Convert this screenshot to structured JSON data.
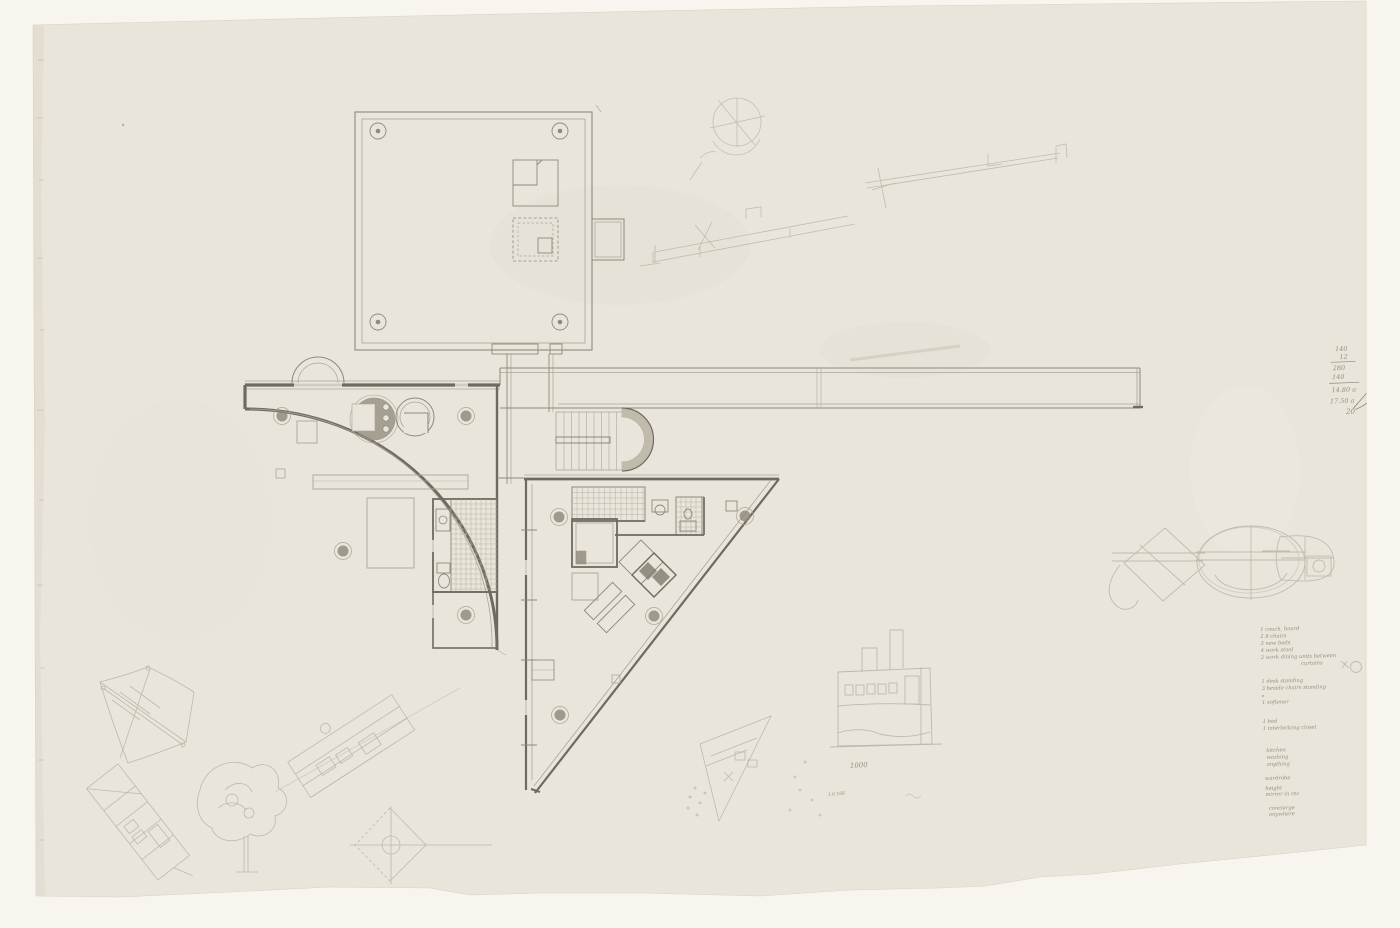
{
  "artwork": {
    "kind": "graphite floor-plan drawing on cream tracing paper",
    "sheet_number": "20"
  },
  "calc_block": {
    "line1": "140",
    "line2": "12",
    "line3": "280",
    "line4": "140",
    "line5": "14.80 a",
    "line6": "17.50 a"
  },
  "notes": {
    "group1": [
      "1 couch, board",
      "2 8 chairs",
      "3 new beds",
      "4 work stool",
      "2 work dining units between",
      "curtains"
    ],
    "group2": [
      "1 desk standing",
      "3 beside chairs standing",
      "1 softener"
    ],
    "group3": [
      "1 bed",
      "1 interlocking closet"
    ],
    "group4": [
      "kitchen",
      "washing",
      "anything",
      "wardrobe",
      "height",
      "mirror in rec",
      "concierge",
      "anywhere"
    ]
  },
  "scatter": {
    "value_1000": "1000",
    "value_16": "1.6 166"
  },
  "colors": {
    "paper": "#eae5db",
    "backdrop": "#f8f5ee",
    "pencil_dark": "#6f6a60",
    "pencil_medium": "#8e897d",
    "pencil_light": "#aaa498",
    "pencil_faint": "#b7b1a4"
  }
}
